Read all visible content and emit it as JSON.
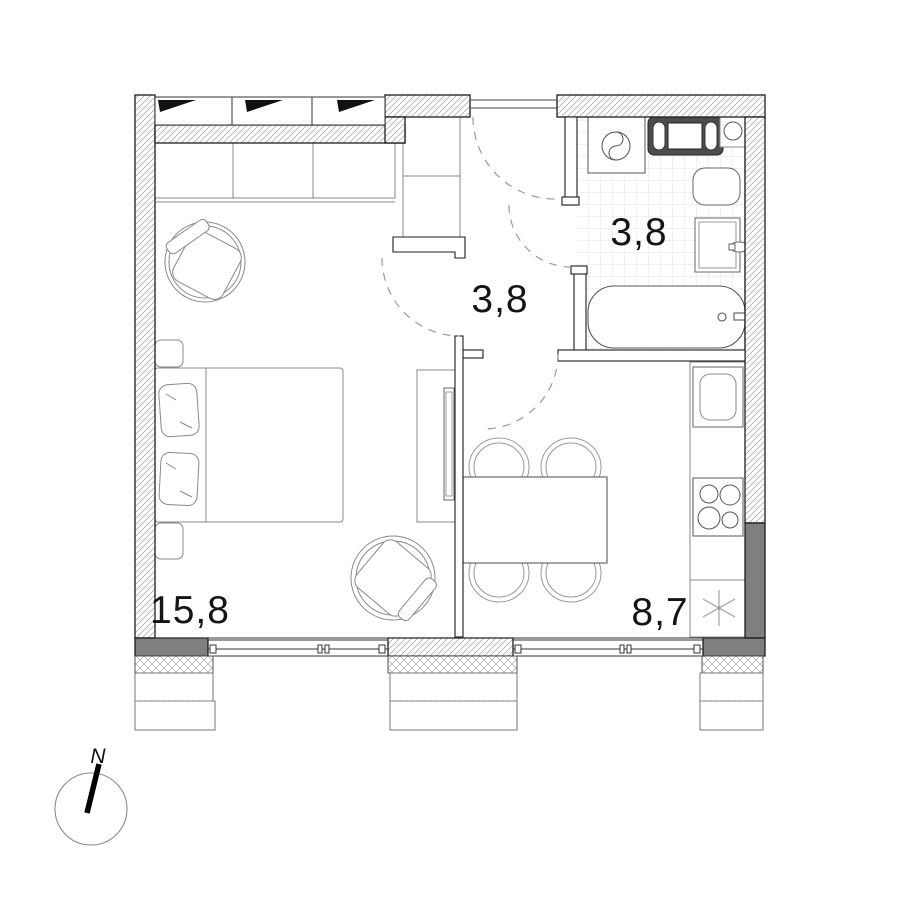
{
  "plan": {
    "rooms": [
      {
        "id": "living-room",
        "area_label": "15,8"
      },
      {
        "id": "hallway",
        "area_label": "3,8"
      },
      {
        "id": "bathroom",
        "area_label": "3,8"
      },
      {
        "id": "kitchen",
        "area_label": "8,7"
      }
    ],
    "compass": {
      "north_label": "N"
    },
    "colors": {
      "line": "#1c1c1c",
      "wall_dark_fill": "#7f7f7f",
      "furniture_line": "#8a8a8a",
      "hatch_line": "#8f8f8f",
      "tile_line": "#e6e3df",
      "label_text": "#141414"
    }
  }
}
